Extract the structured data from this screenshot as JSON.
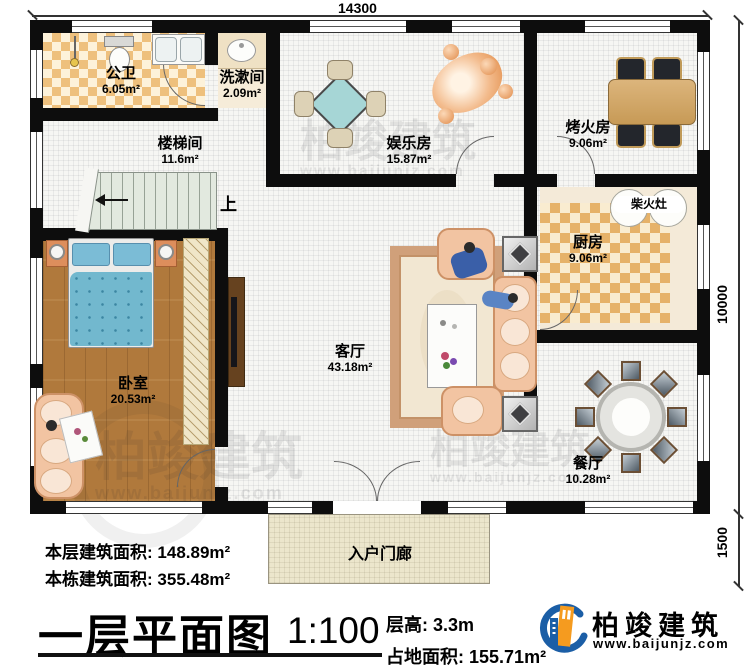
{
  "plan": {
    "dimensions": {
      "top": "14300",
      "right_main": "10000",
      "right_porch": "1500"
    },
    "rooms": [
      {
        "name": "公卫",
        "area": "6.05m²"
      },
      {
        "name": "洗漱间",
        "area": "2.09m²"
      },
      {
        "name": "楼梯间",
        "area": "11.6m²"
      },
      {
        "name": "娱乐房",
        "area": "15.87m²"
      },
      {
        "name": "烤火房",
        "area": "9.06m²"
      },
      {
        "name": "厨房",
        "area": "9.06m²"
      },
      {
        "name": "客厅",
        "area": "43.18m²"
      },
      {
        "name": "卧室",
        "area": "20.53m²"
      },
      {
        "name": "餐厅",
        "area": "10.28m²"
      }
    ],
    "stove_label": "柴火灶",
    "porch_label": "入户门廊",
    "stairs_up": "上"
  },
  "footer": {
    "floor_area_label": "本层建筑面积:",
    "floor_area_value": "148.89m²",
    "building_area_label": "本栋建筑面积:",
    "building_area_value": "355.48m²",
    "title": "一层平面图",
    "scale": "1:100",
    "story_height_label": "层高:",
    "story_height_value": "3.3m",
    "land_area_label": "占地面积:",
    "land_area_value": "155.71m²"
  },
  "logo": {
    "name": "柏竣建筑",
    "url": "www.baijunjz.com"
  },
  "watermark": {
    "text": "柏竣建筑",
    "url": "www.baijunjz.com"
  },
  "colors": {
    "wall": "#0d0d0d",
    "checker": "#eec07d",
    "wood": "#b0793c",
    "bed": "#74b8ce",
    "sofa": "#f2c4a2",
    "logo_blue": "#1b5ea6",
    "logo_orange": "#f59b1f"
  }
}
